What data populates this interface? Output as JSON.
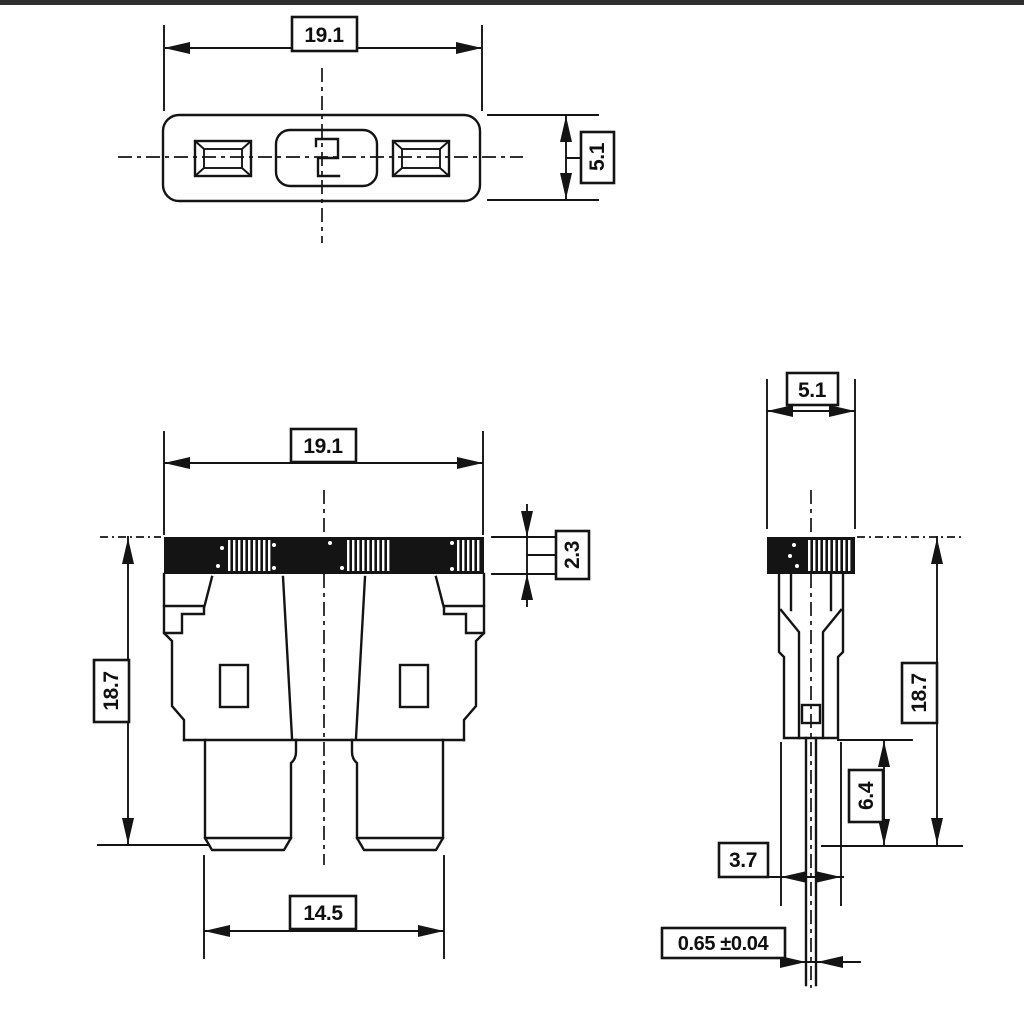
{
  "drawing": {
    "background": "#ffffff",
    "line_color": "#141414",
    "top_view": {
      "width": "19.1",
      "depth": "5.1"
    },
    "front_view": {
      "width": "19.1",
      "cap_height": "2.3",
      "height": "18.7",
      "terminal_span": "14.5"
    },
    "side_view": {
      "depth": "5.1",
      "height": "18.7",
      "terminal_length": "6.4",
      "foot_width": "3.7",
      "terminal_thickness": "0.65 ±0.04"
    }
  }
}
